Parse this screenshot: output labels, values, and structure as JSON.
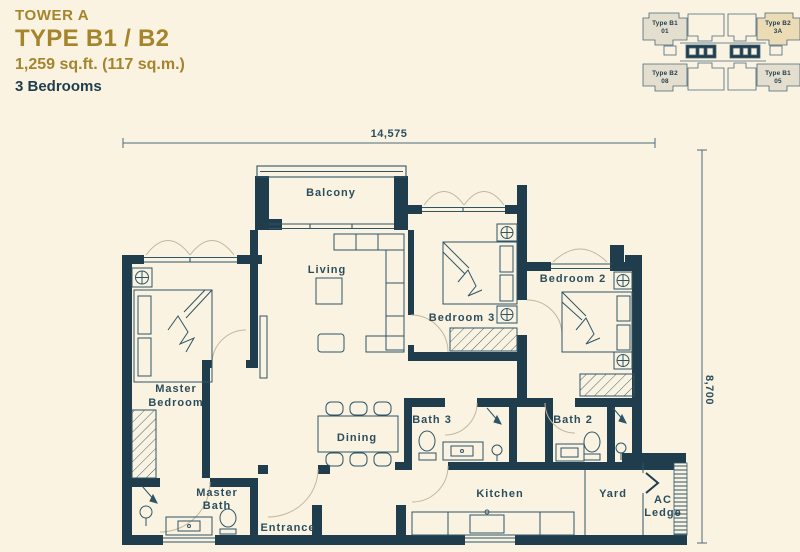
{
  "header": {
    "tower": "TOWER A",
    "type": "TYPE B1 / B2",
    "area": "1,259 sq.ft. (117 sq.m.)",
    "bedrooms": "3 Bedrooms"
  },
  "key_plan": {
    "units": [
      {
        "line1": "Type B1",
        "line2": "01",
        "position": "top-left"
      },
      {
        "line1": "Type B2",
        "line2": "3A",
        "position": "top-right"
      },
      {
        "line1": "Type B2",
        "line2": "08",
        "position": "bottom-left"
      },
      {
        "line1": "Type B1",
        "line2": "05",
        "position": "bottom-right"
      }
    ]
  },
  "floor_plan": {
    "rooms": {
      "balcony": "Balcony",
      "living": "Living",
      "master_bedroom": [
        "Master",
        "Bedroom"
      ],
      "bedroom3": "Bedroom 3",
      "bedroom2": "Bedroom 2",
      "dining": "Dining",
      "bath3": "Bath 3",
      "bath2": "Bath 2",
      "master_bath": [
        "Master",
        "Bath"
      ],
      "entrance": "Entrance",
      "kitchen": "Kitchen",
      "yard": "Yard",
      "ac_ledge": [
        "AC",
        "Ledge"
      ]
    },
    "dimensions": {
      "width": "14,575",
      "height": "8,700"
    }
  },
  "colors": {
    "background": "#faf3e2",
    "wall": "#1f3d4c",
    "line": "#2f5565",
    "arc": "#c3b89e",
    "gold": "#a5842c",
    "key_unit_fill": "#e4decf",
    "key_unit_highlight": "#ecdcb6"
  }
}
